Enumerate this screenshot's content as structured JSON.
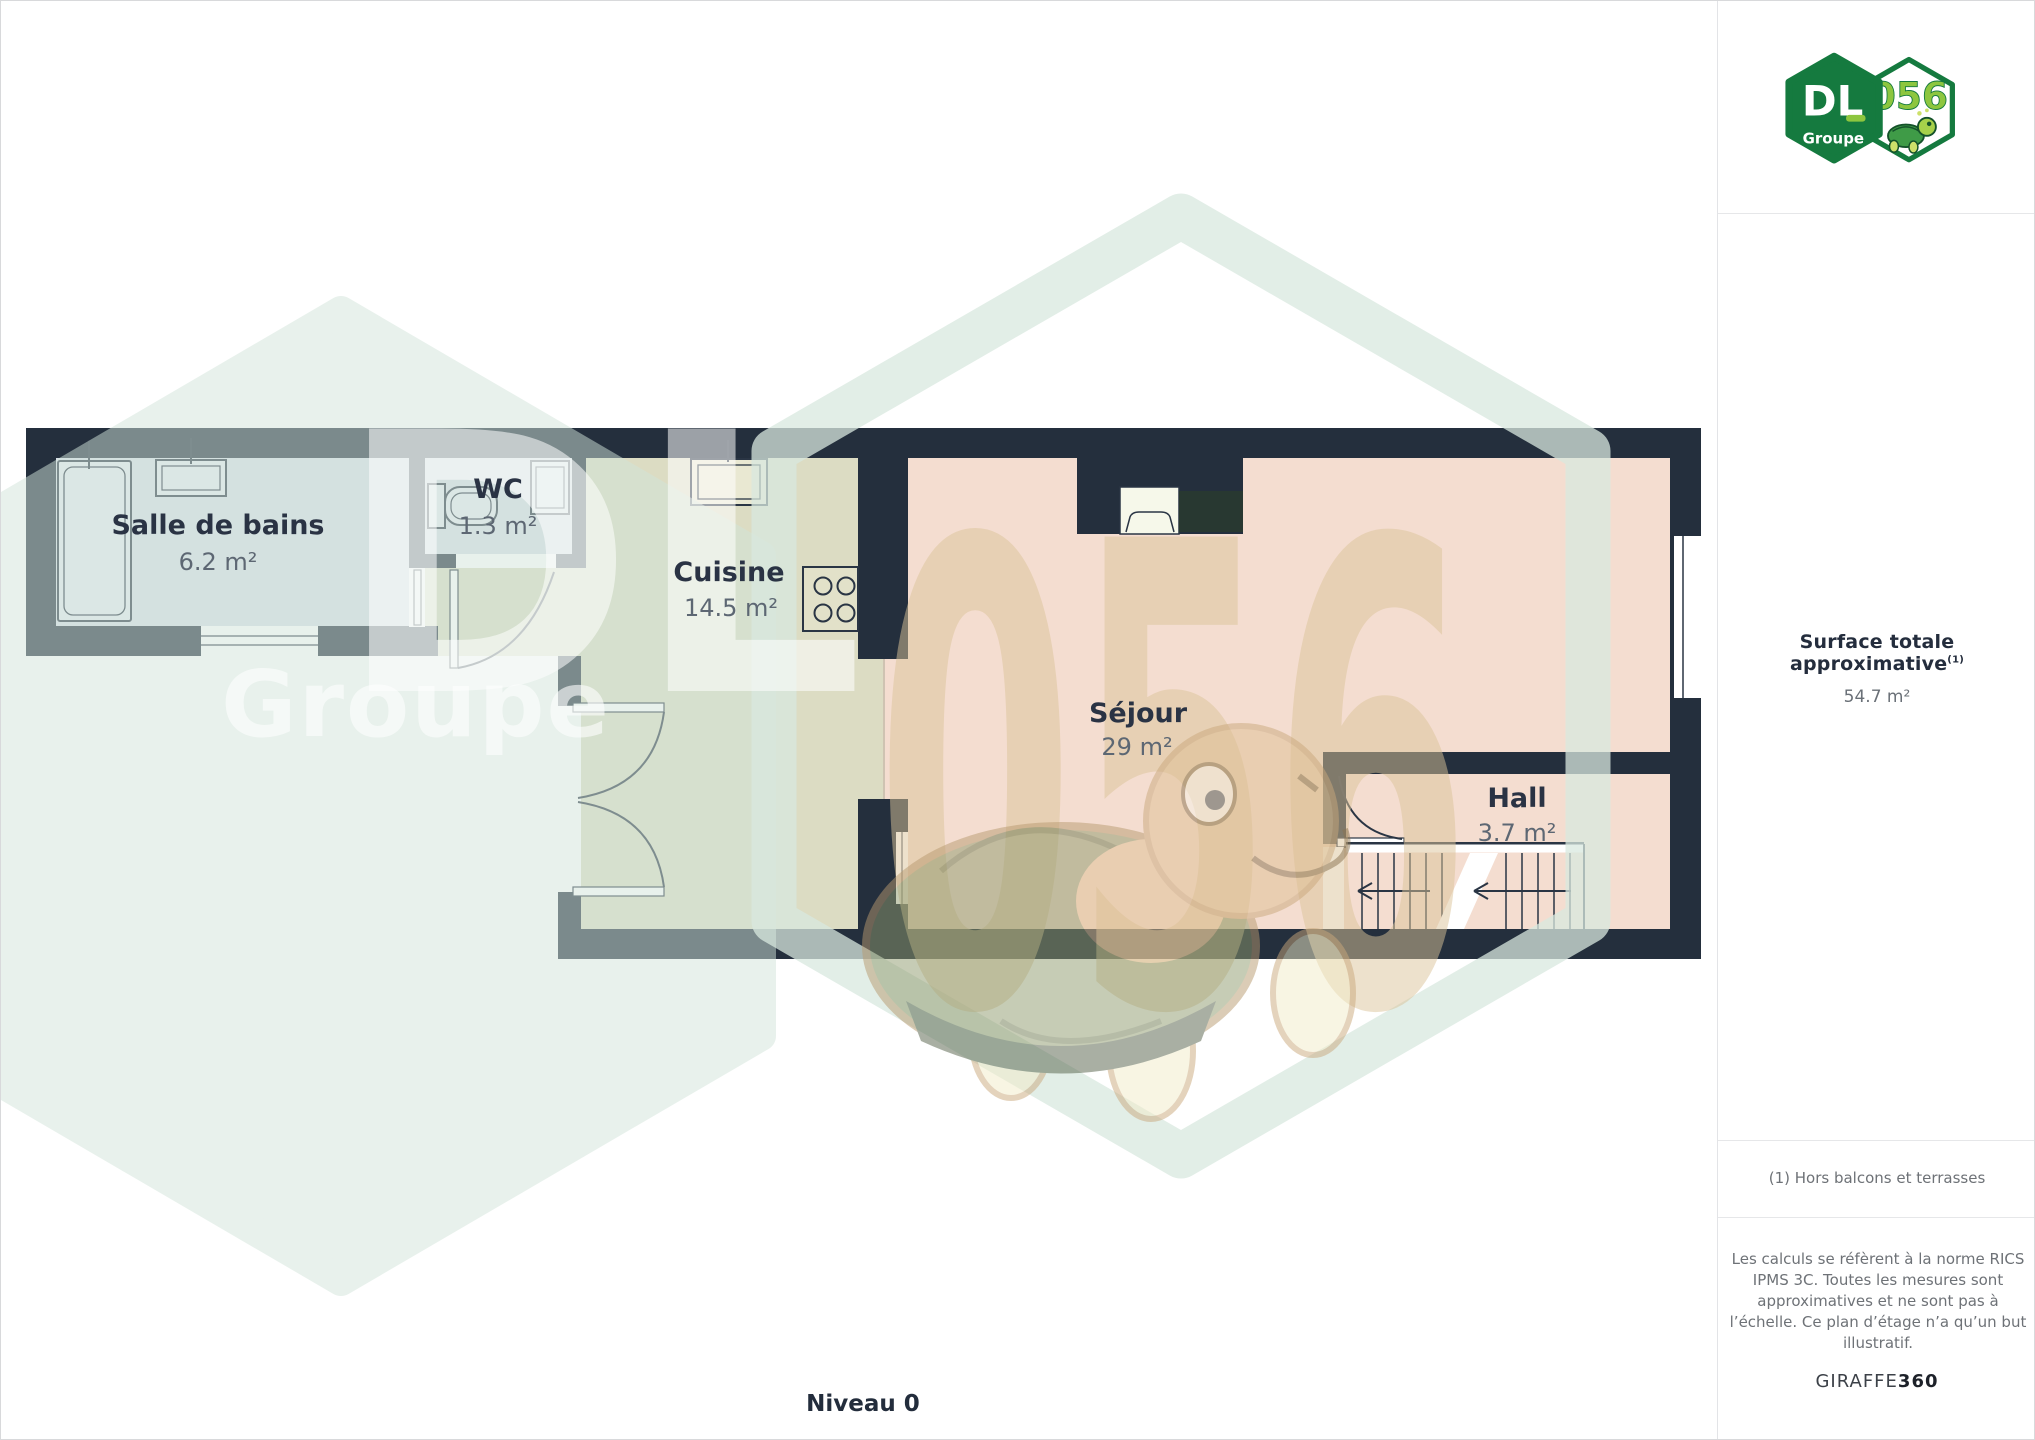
{
  "logo": {
    "dl": "DL",
    "groupe": "Groupe",
    "badge": "056"
  },
  "sidebar": {
    "surface_label": "Surface totale approximative",
    "surface_sup": "(1)",
    "surface_value": "54.7 m²",
    "footnote": "(1) Hors balcons et terrasses",
    "disclaimer": "Les calculs se réfèrent à la norme RICS IPMS 3C. Toutes les mesures sont approximatives et ne sont pas à l’échelle. Ce plan d’étage n’a qu’un but illustratif.",
    "brand": "GIRAFFE",
    "brand_bold": "360"
  },
  "plan": {
    "level_label": "Niveau 0",
    "rooms": [
      {
        "name": "Salle de bains",
        "area": "6.2 m²"
      },
      {
        "name": "WC",
        "area": "1.3 m²"
      },
      {
        "name": "Cuisine",
        "area": "14.5 m²"
      },
      {
        "name": "Séjour",
        "area": "29 m²"
      },
      {
        "name": "Hall",
        "area": "3.7 m²"
      }
    ],
    "watermark_badge": "056",
    "watermark_dl": "DL",
    "watermark_groupe": "Groupe"
  },
  "colors": {
    "wall": "#242f3d",
    "bath_floor": "#d7dee7",
    "kitchen_floor": "#dcdcc3",
    "living_floor": "#f4ddd0",
    "label": "#2a3344",
    "area_text": "#5d6773",
    "brand_green_dark": "#157a3f",
    "brand_green_lime": "#8dc63f",
    "watermark_green": "#d2e4da",
    "watermark_beige": "#dcc49a"
  }
}
